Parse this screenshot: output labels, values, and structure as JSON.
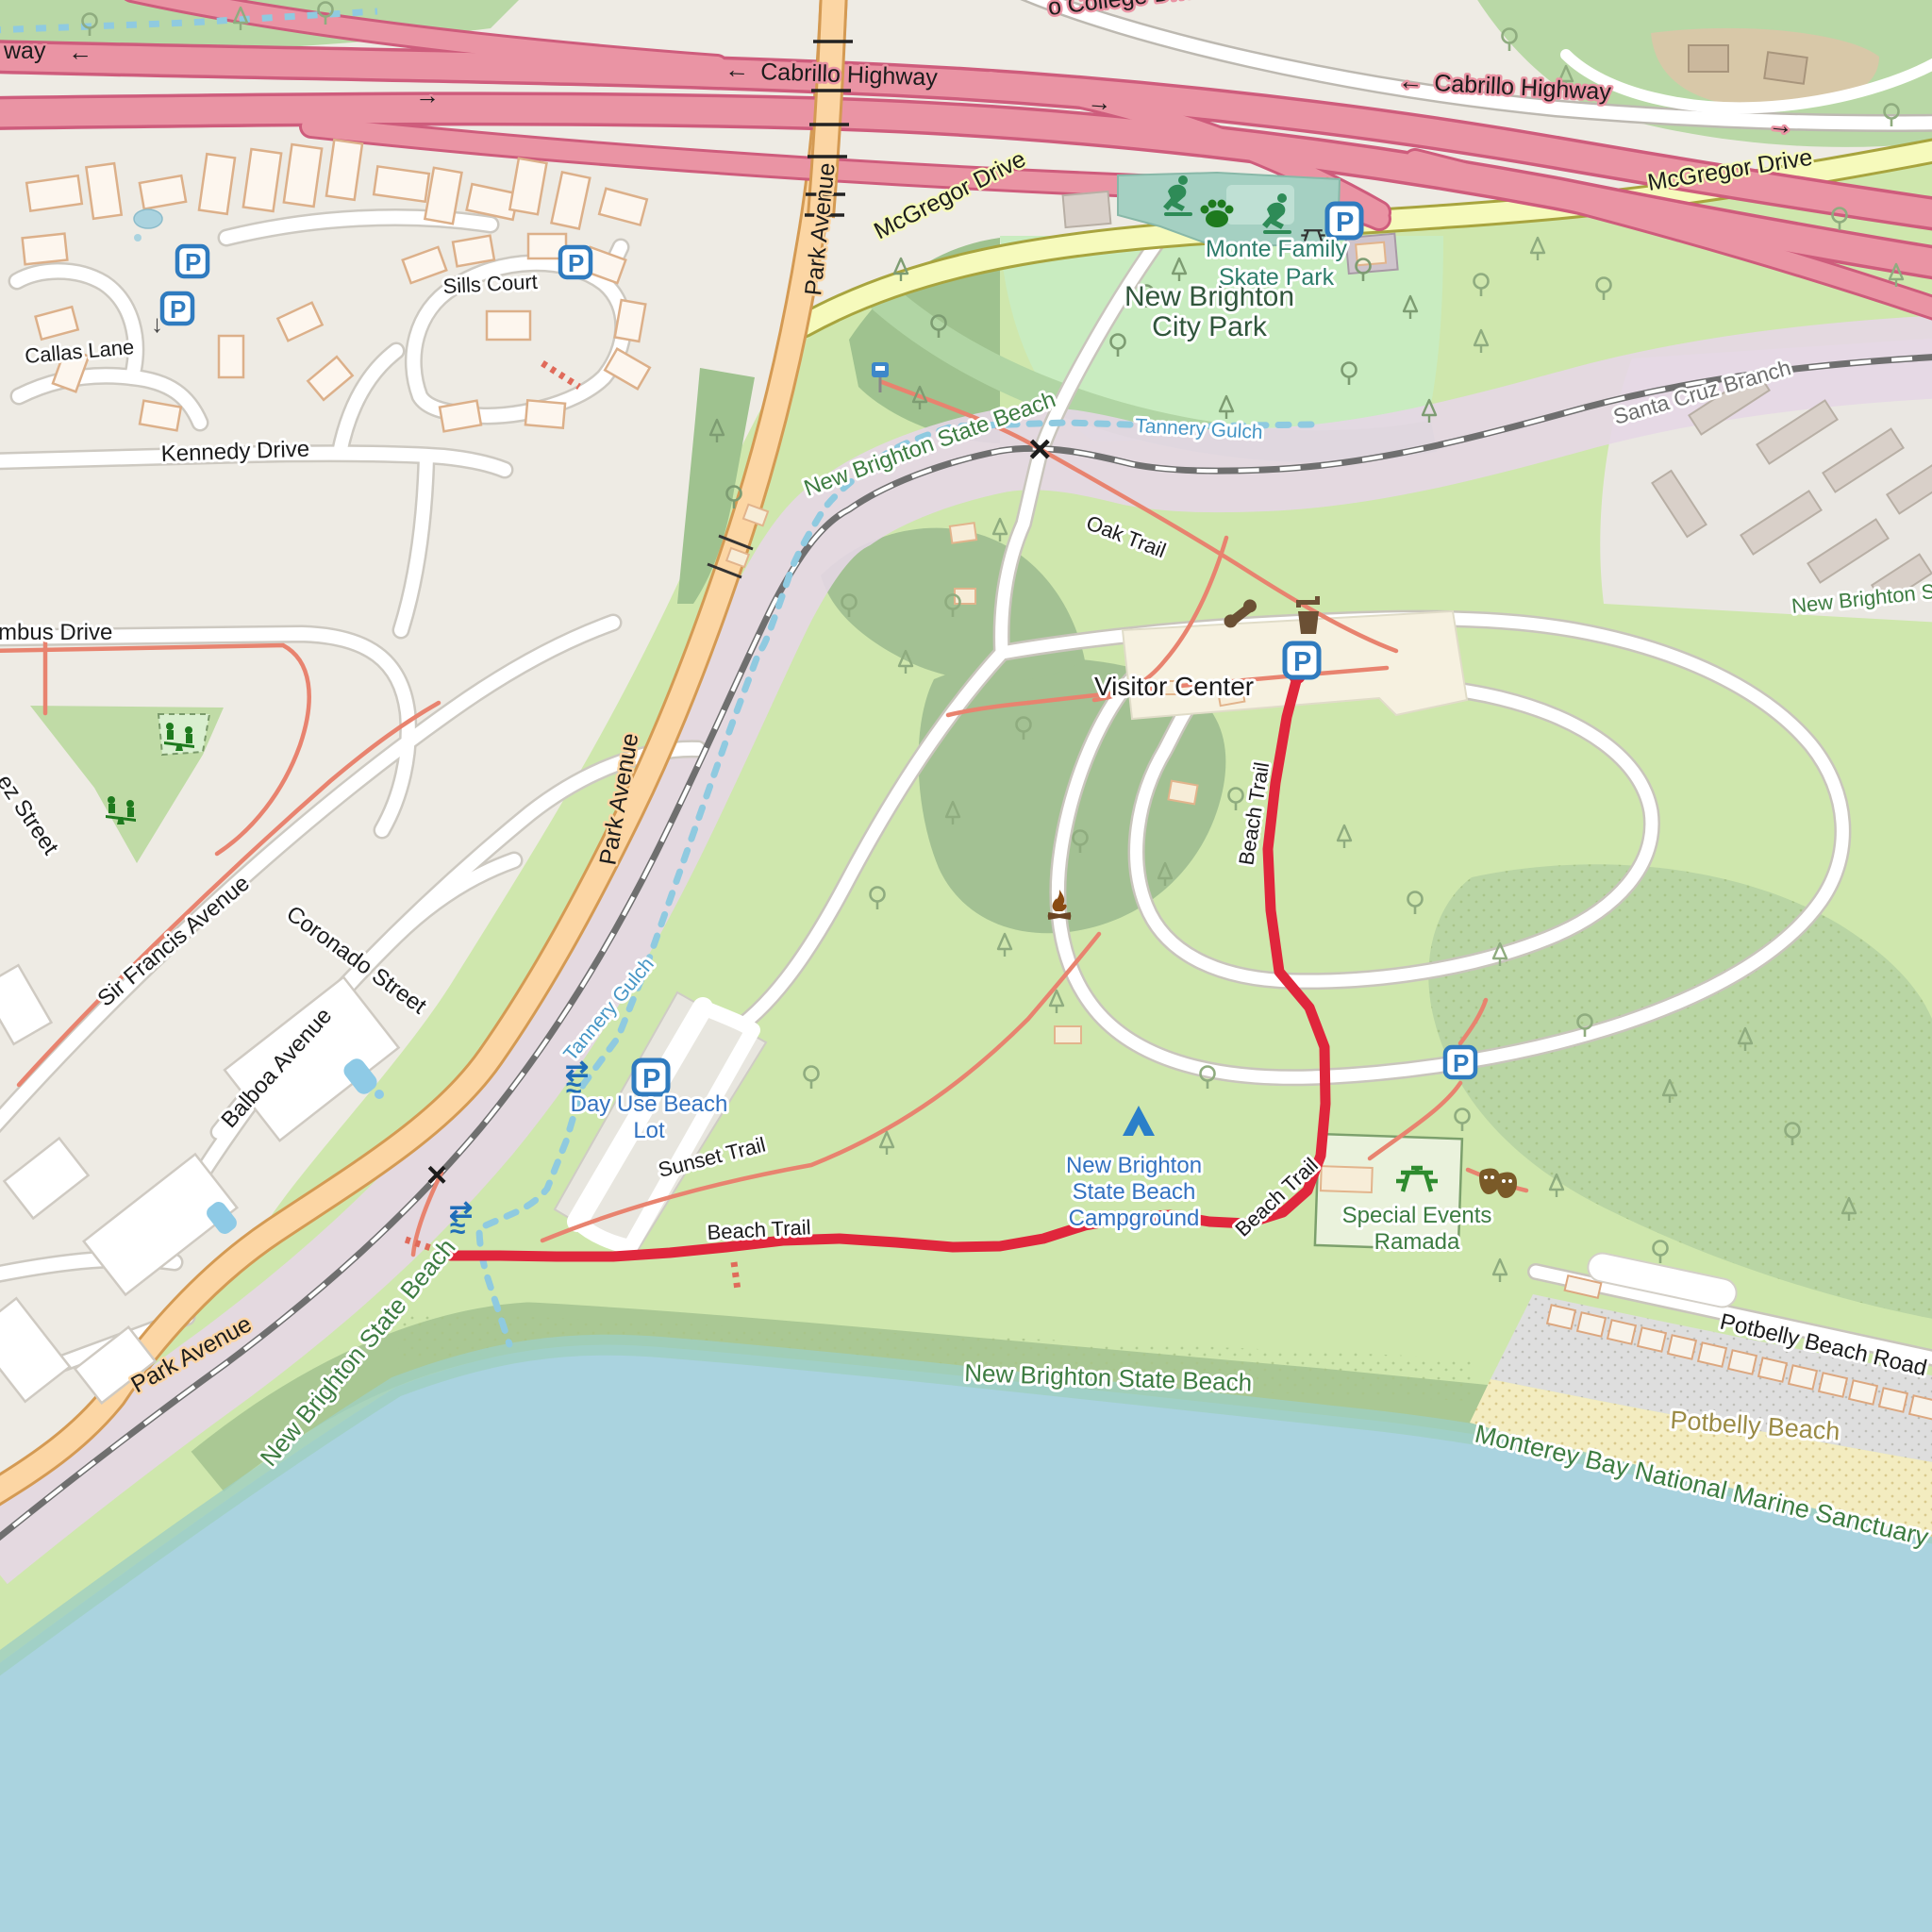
{
  "map_labels": {
    "highways": {
      "college_drive_partial": "o College Drive",
      "cabrillo_way_partial": "way",
      "cabrillo_highway": "Cabrillo Highway",
      "mcgregor_drive": "McGregor Drive",
      "park_avenue": "Park Avenue",
      "kennedy_drive": "Kennedy Drive",
      "callas_lane": "Callas Lane",
      "sills_court": "Sills Court",
      "columbus_drive_partial": "mbus Drive",
      "ez_street_partial": "ez Street",
      "sir_francis_avenue": "Sir Francis Avenue",
      "coronado_street": "Coronado Street",
      "balboa_avenue": "Balboa Avenue",
      "potbelly_beach_road": "Potbelly Beach Road"
    },
    "railway": {
      "santa_cruz_branch": "Santa Cruz Branch"
    },
    "trails": {
      "beach_trail": "Beach Trail",
      "oak_trail": "Oak Trail",
      "sunset_trail": "Sunset Trail"
    },
    "areas": {
      "city_park_line1": "New Brighton",
      "city_park_line2": "City Park",
      "skate_park_line1": "Monte Family",
      "skate_park_line2": "Skate Park",
      "state_beach": "New Brighton State Beach",
      "state_beach_partial": "New Brighton S",
      "tannery_gulch": "Tannery Gulch",
      "potbelly_beach": "Potbelly Beach",
      "marine_sanctuary": "Monterey Bay National Marine Sanctuary"
    },
    "pois": {
      "visitor_center": "Visitor Center",
      "day_use_line1": "Day Use Beach",
      "day_use_line2": "Lot",
      "campground_line1": "New Brighton",
      "campground_line2": "State Beach",
      "campground_line3": "Campground",
      "ramada_line1": "Special Events",
      "ramada_line2": "Ramada"
    },
    "symbols": {
      "parking": "P",
      "arrow_left": "←",
      "arrow_right": "→",
      "arrow_down": "↓",
      "crossing": "×",
      "waterfall_arrows": "⇄",
      "waterfall_wave": "≈"
    }
  },
  "colors": {
    "motorway": "#ea94a4",
    "secondary_road": "#f6fabc",
    "primary_road": "#fcd6a4",
    "park_green": "#cfe7ad",
    "woods_green": "#a3c193",
    "water_blue": "#aad3df",
    "sand": "#f3ecc0",
    "railway_corridor": "#e5d7e6",
    "route_red": "#e0263c",
    "poi_label_blue": "#3372c0",
    "park_label_green": "#3d7c41"
  }
}
